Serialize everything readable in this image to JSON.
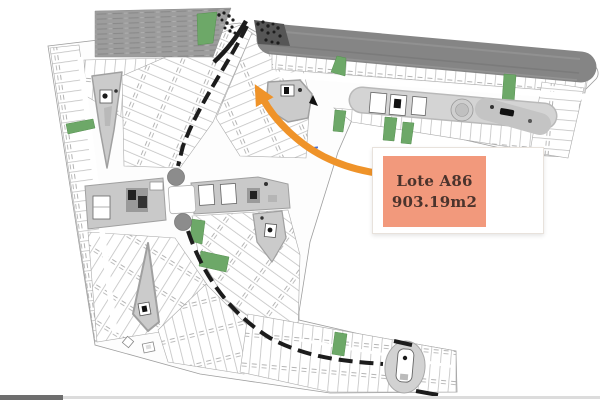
{
  "callout": {
    "title": "Lote A86",
    "area": "903.19m2"
  },
  "colors": {
    "callout_bg": "#f2997c",
    "callout_text": "#4b332c",
    "arrow_orange": "#ef9329",
    "green_area": "#6da868",
    "highway_gray": "#858585",
    "field_gray": "#9d9d9d",
    "road_black": "#1c1c1c",
    "park_gray": "#c9c9c9",
    "lot_line_gray": "#b9b9b9",
    "marker_red": "#b5442c"
  },
  "map": {
    "type": "site-plan",
    "features": [
      "perimeter-highway",
      "hatched-field",
      "dashed-main-road",
      "upper-roundabout",
      "lower-roundabout",
      "residential-lot-blocks",
      "green-lots",
      "amenity-parks",
      "sports-courts",
      "clubhouse",
      "pool-amenity",
      "tree-clusters",
      "target-lot-arrow",
      "north-marker",
      "red-map-marker"
    ]
  }
}
